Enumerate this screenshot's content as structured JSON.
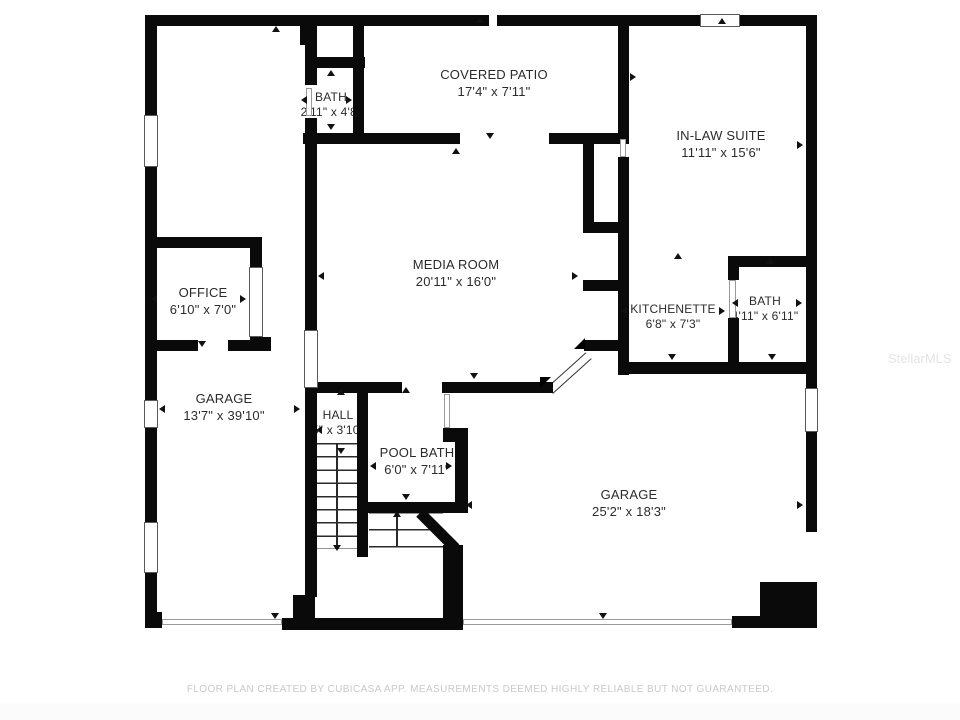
{
  "watermark": "StellarMLS",
  "footer": "FLOOR PLAN CREATED BY CUBICASA APP. MEASUREMENTS DEEMED HIGHLY RELIABLE BUT NOT GUARANTEED.",
  "colors": {
    "wall": "#0a0a0a",
    "label": "#2b2b2b",
    "footer_text": "#c9c9c9",
    "watermark_text": "#e4e4e4",
    "background": "#ffffff"
  },
  "rooms": [
    {
      "id": "bath-top",
      "name": "BATH",
      "dims": "2'11\" x 4'8\""
    },
    {
      "id": "covered-patio",
      "name": "COVERED PATIO",
      "dims": "17'4\" x 7'11\""
    },
    {
      "id": "in-law-suite",
      "name": "IN-LAW SUITE",
      "dims": "11'11\" x 15'6\""
    },
    {
      "id": "media-room",
      "name": "MEDIA ROOM",
      "dims": "20'11\" x 16'0\""
    },
    {
      "id": "office",
      "name": "OFFICE",
      "dims": "6'10\" x 7'0\""
    },
    {
      "id": "kitchenette",
      "name": "KITCHENETTE",
      "dims": "6'8\" x 7'3\""
    },
    {
      "id": "bath-right",
      "name": "BATH",
      "dims": "4'11\" x 6'11\""
    },
    {
      "id": "garage-left",
      "name": "GARAGE",
      "dims": "13'7\" x 39'10\""
    },
    {
      "id": "hall",
      "name": "HALL",
      "dims": "5\" x 3'10\""
    },
    {
      "id": "pool-bath",
      "name": "POOL BATH",
      "dims": "6'0\" x 7'11\""
    },
    {
      "id": "garage-right",
      "name": "GARAGE",
      "dims": "25'2\" x 18'3\""
    }
  ]
}
